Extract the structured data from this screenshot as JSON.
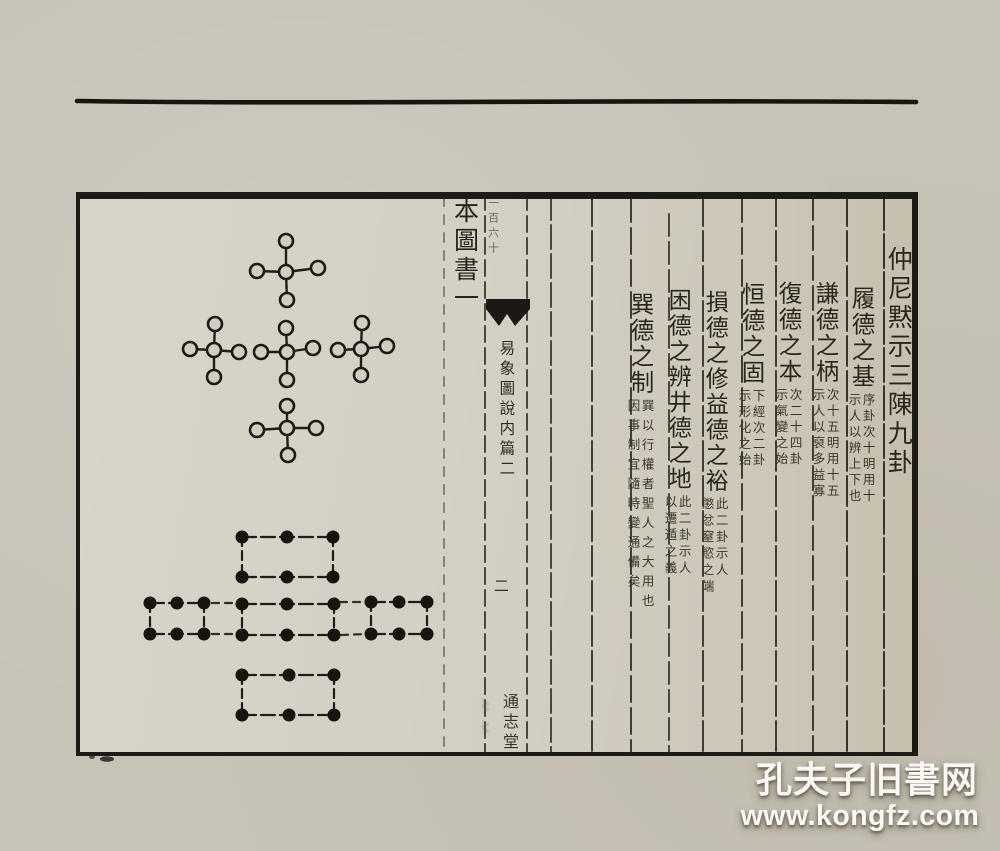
{
  "page": {
    "header_column": {
      "text": "本圖書一"
    },
    "spine": {
      "handwritten": "一百六十",
      "title": "易象圖說内篇二",
      "page_number": "二",
      "publisher": "通志堂"
    },
    "text_columns": [
      {
        "main": "仲尼黙示三陳九卦",
        "ann_right": "",
        "ann_left": ""
      },
      {
        "main": "履德之基",
        "ann_right": "序卦次十明用十",
        "ann_left": "示人以辨上下也"
      },
      {
        "main": "謙德之柄",
        "ann_right": "次十五明用十五",
        "ann_left": "示人以裒多益寡"
      },
      {
        "main": "復德之本",
        "ann_right": "次二十四卦",
        "ann_left": "示氣變之始"
      },
      {
        "main": "恒德之固",
        "ann_right": "下經次二卦",
        "ann_left": "示形化之始"
      },
      {
        "main": "損德之修益德之裕",
        "ann_right": "此二卦示人",
        "ann_left": "懲忿窒慾之端"
      },
      {
        "main": "困德之辨井德之地",
        "ann_right": "此二卦示人",
        "ann_left": "以遷遁之義"
      },
      {
        "main": "巽德之制",
        "ann_right": "巽以行權者聖人之大用也",
        "ann_left": "因事制宜隨時變通備矣"
      }
    ]
  },
  "diagrams": {
    "heaven_numbers": {
      "circle_radius": 7,
      "units": [
        {
          "c": [
            286,
            272
          ],
          "arms": [
            [
              286,
              241
            ],
            [
              287,
              300
            ],
            [
              318,
              268
            ],
            [
              257,
              271
            ]
          ]
        },
        {
          "c": [
            214,
            350
          ],
          "arms": [
            [
              215,
              324
            ],
            [
              214,
              377
            ],
            [
              239,
              352
            ],
            [
              190,
              349
            ]
          ]
        },
        {
          "c": [
            287,
            352
          ],
          "arms": [
            [
              286,
              328
            ],
            [
              287,
              380
            ],
            [
              313,
              348
            ],
            [
              261,
              352
            ]
          ]
        },
        {
          "c": [
            361,
            349
          ],
          "arms": [
            [
              362,
              323
            ],
            [
              361,
              375
            ],
            [
              387,
              346
            ],
            [
              338,
              350
            ]
          ]
        },
        {
          "c": [
            287,
            428
          ],
          "arms": [
            [
              287,
              406
            ],
            [
              288,
              455
            ],
            [
              316,
              428
            ],
            [
              257,
              430
            ]
          ]
        }
      ]
    },
    "earth_numbers": {
      "dot_radius": 6.5,
      "groups": [
        {
          "cols": [
            242,
            287,
            333
          ],
          "rows": [
            537,
            577
          ]
        },
        {
          "cols": [
            150,
            177,
            204
          ],
          "rows": [
            603,
            634
          ]
        },
        {
          "cols": [
            242,
            287,
            334
          ],
          "rows": [
            604,
            635
          ]
        },
        {
          "cols": [
            371,
            399,
            427
          ],
          "rows": [
            602,
            634
          ]
        },
        {
          "cols": [
            242,
            289,
            334
          ],
          "rows": [
            675,
            715
          ]
        }
      ],
      "connectors": [
        [
          212,
          603,
          234,
          603
        ],
        [
          212,
          634,
          233,
          634
        ],
        [
          340,
          602,
          364,
          602
        ],
        [
          341,
          635,
          366,
          634
        ]
      ]
    }
  },
  "watermark": {
    "line1": "孔夫子旧書网",
    "line2": "www.kongfz.com"
  },
  "colors": {
    "paper": "#c7c3b7",
    "paper_inner": "#d0ccc0",
    "ink": "#1d1b16",
    "rule_ink": "#2a2720",
    "watermark_text": "#f9f8f4"
  }
}
